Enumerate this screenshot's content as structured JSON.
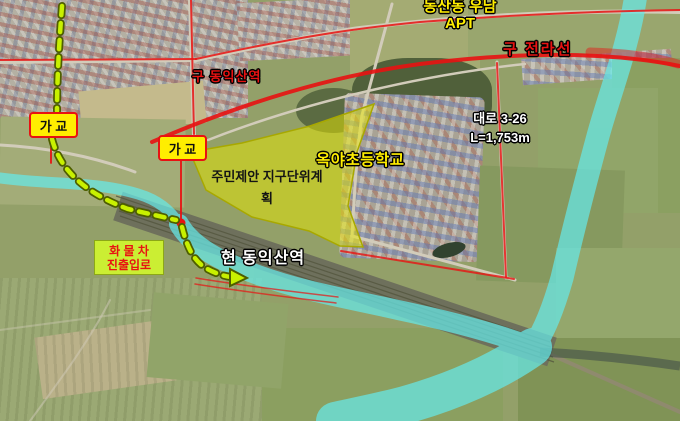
{
  "labels": {
    "apartment_line1": "동산동 우남",
    "apartment_line2": "APT",
    "old_rail_line": "구 전라선",
    "old_station": "구 동익산역",
    "temp_bridge": "가 교",
    "district_plan_line1": "주민제안 지구단위계",
    "district_plan_line2": "획",
    "school": "옥야초등학교",
    "road_name": "대로 3-26",
    "road_length": "L=1,753m",
    "freight_line1": "화 물 차",
    "freight_line2": "진출입로",
    "current_station": "현 동익산역"
  },
  "colors": {
    "highlight_yellow": "#ffee00",
    "annotation_red": "#e81212",
    "river_overlay": "#66e9e9",
    "route_green": "#c8f000",
    "route_outline": "#4e5e00",
    "district_fill": "#e7e700",
    "district_border": "#a8a800",
    "freight_box_bg": "#cbee33"
  }
}
